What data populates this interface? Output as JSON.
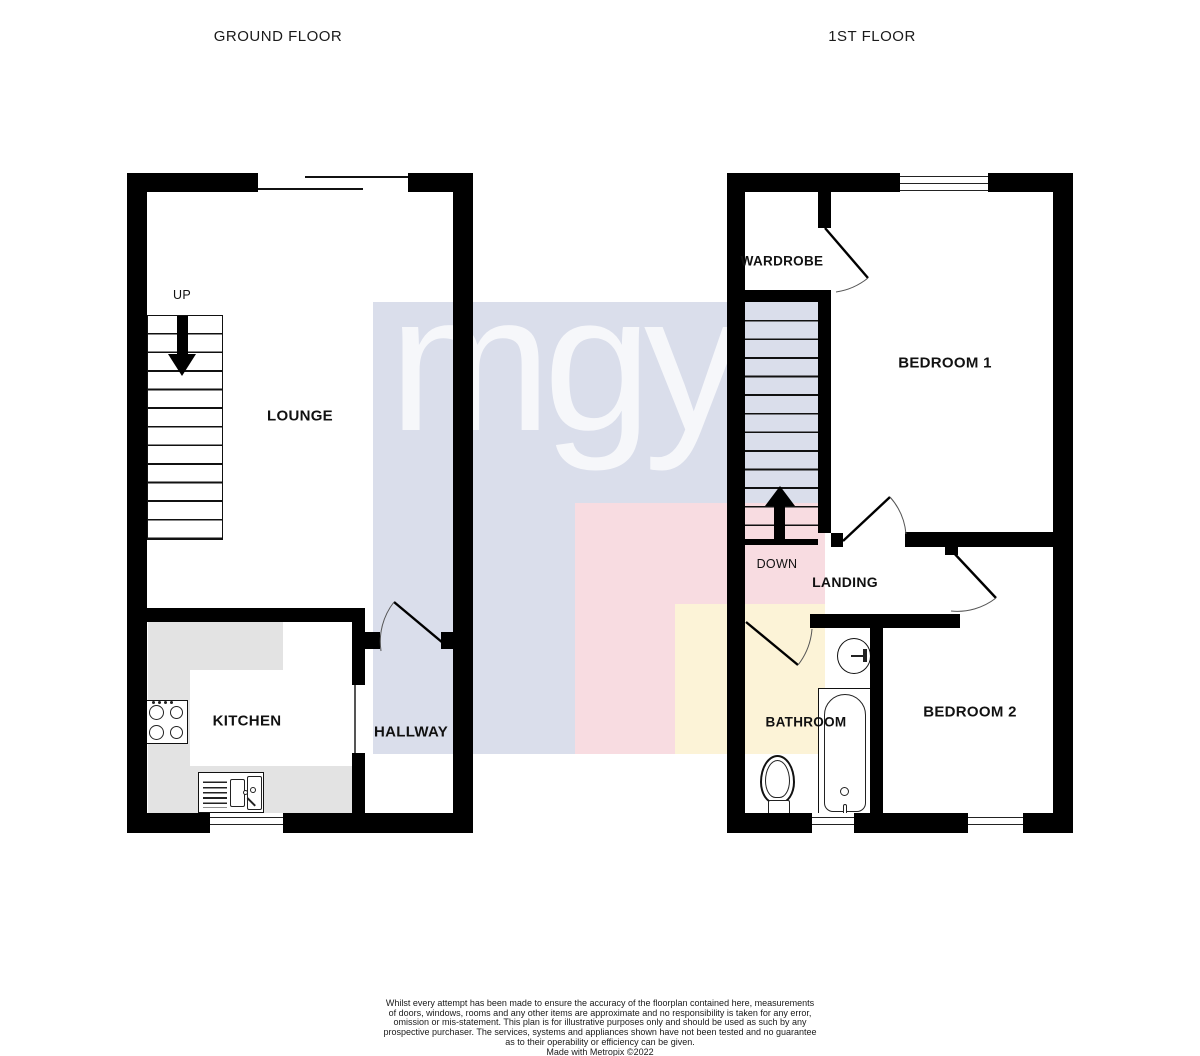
{
  "page": {
    "background": "#ffffff",
    "titles": {
      "ground": "GROUND FLOOR",
      "first": "1ST FLOOR"
    }
  },
  "watermark": {
    "text": "mgy",
    "colors": {
      "blue": "#dadeeb",
      "pink": "#f8dce1",
      "yellow": "#fcf3d7"
    }
  },
  "ground_floor": {
    "stairs_label": "UP",
    "rooms": {
      "lounge": "LOUNGE",
      "kitchen": "KITCHEN",
      "hallway": "HALLWAY"
    }
  },
  "first_floor": {
    "stairs_label": "DOWN",
    "rooms": {
      "wardrobe": "WARDROBE",
      "bedroom1": "BEDROOM 1",
      "landing": "LANDING",
      "bathroom": "BATHROOM",
      "bedroom2": "BEDROOM 2"
    }
  },
  "footer": {
    "lines": [
      "Whilst every attempt has been made to ensure the accuracy of the floorplan contained here, measurements",
      "of doors, windows, rooms and any other items are approximate and no responsibility is taken for any error,",
      "omission or mis-statement. This plan is for illustrative purposes only and should be used as such by any",
      "prospective purchaser. The services, systems and appliances shown have not been tested and no guarantee",
      "as to their operability or efficiency can be given.",
      "Made with Metropix ©2022"
    ]
  }
}
